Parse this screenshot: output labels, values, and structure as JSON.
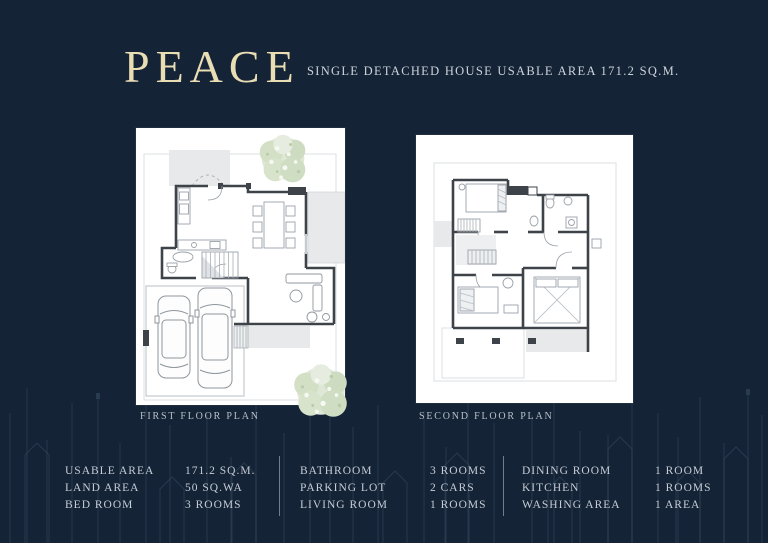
{
  "header": {
    "title": "PEACE",
    "subtitle": "SINGLE DETACHED HOUSE USABLE AREA 171.2 SQ.M."
  },
  "plans": {
    "first": {
      "caption": "FIRST FLOOR PLAN"
    },
    "second": {
      "caption": "SECOND FLOOR PLAN"
    }
  },
  "specs": {
    "group1": {
      "rows": [
        {
          "label": "USABLE AREA",
          "value": "171.2 SQ.M."
        },
        {
          "label": "LAND AREA",
          "value": "50 SQ.WA"
        },
        {
          "label": "BED ROOM",
          "value": "3 ROOMS"
        }
      ]
    },
    "group2": {
      "rows": [
        {
          "label": "BATHROOM",
          "value": "3 ROOMS"
        },
        {
          "label": "PARKING LOT",
          "value": "2 CARS"
        },
        {
          "label": "LIVING ROOM",
          "value": "1 ROOMS"
        }
      ]
    },
    "group3": {
      "rows": [
        {
          "label": "DINING ROOM",
          "value": "1 ROOM"
        },
        {
          "label": "KITCHEN",
          "value": "1 ROOMS"
        },
        {
          "label": "WASHING AREA",
          "value": "1 AREA"
        }
      ]
    }
  },
  "colors": {
    "background": "#152336",
    "title_gold": "#e9ddb4",
    "text_light": "#c5cdd6",
    "plan_paper": "#ffffff",
    "tree_green": "#d8e3cb"
  }
}
